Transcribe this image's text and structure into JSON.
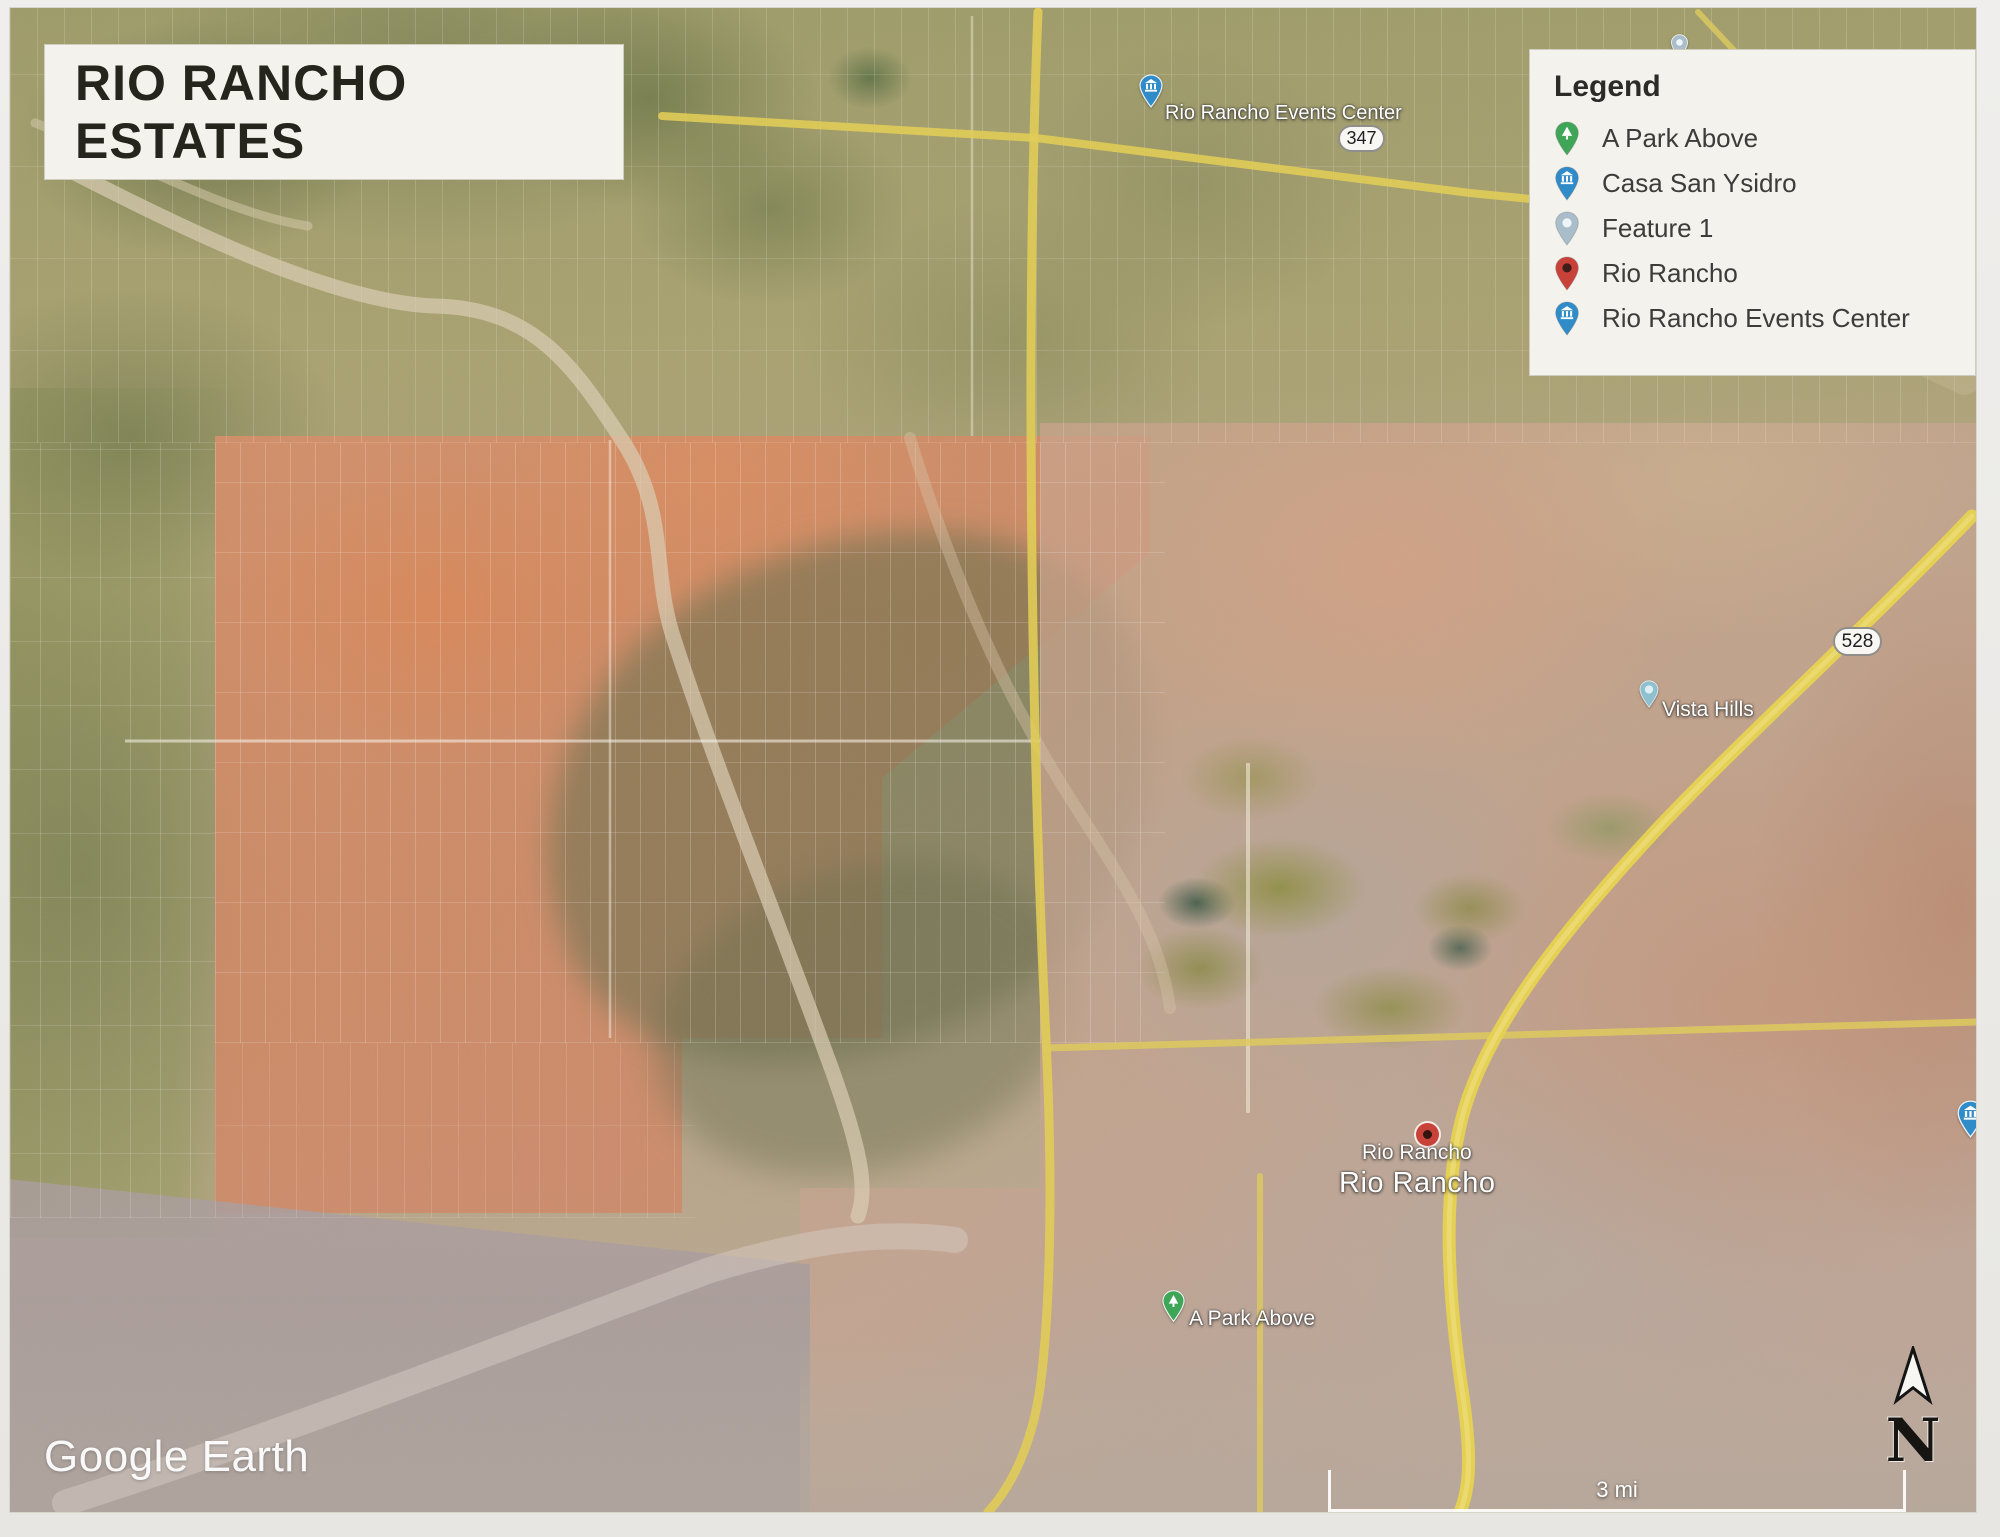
{
  "title": "RIO RANCHO ESTATES",
  "legend": {
    "heading": "Legend",
    "items": [
      {
        "label": "A Park Above"
      },
      {
        "label": "Casa San Ysidro"
      },
      {
        "label": "Feature 1"
      },
      {
        "label": "Rio Rancho"
      },
      {
        "label": "Rio Rancho Events Center"
      }
    ]
  },
  "map_labels": {
    "events_center": "Rio Rancho Events Center",
    "vista_hills": "Vista Hills",
    "rio_rancho_small": "Rio Rancho",
    "rio_rancho_large": "Rio Rancho",
    "park_above": "A Park Above"
  },
  "route_shields": {
    "route_347": "347",
    "route_528": "528"
  },
  "watermark": "Google Earth",
  "compass": {
    "north_label": "N"
  },
  "scale_bar": {
    "label": "3 mi"
  },
  "pins": {
    "park": "#3fa557",
    "casa": "#2f8cc9",
    "feature": "#a9bdcb",
    "rio": "#c8423a",
    "events": "#2f8cc9",
    "vista": "#8fc0cf"
  },
  "colors": {
    "road_yellow": "#e0cb55",
    "panel_bg": "#f4f2ec",
    "title_text": "#25251d",
    "map_label_text": "#ffffff",
    "salmon_overlay": "#d98e68",
    "olive_terrain": "#9a9864"
  }
}
